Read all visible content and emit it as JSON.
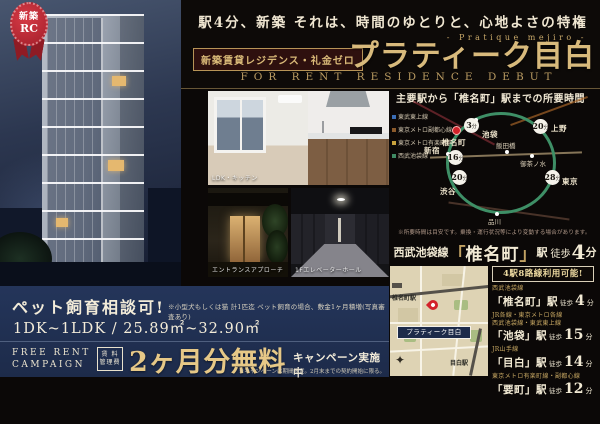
{
  "ribbon": {
    "line1": "新築",
    "line2": "RC"
  },
  "header": {
    "catch": "駅4分、新築 それは、時間のゆとりと、心地よさの特権",
    "sub_en": "- Pratique mejiro -",
    "badge": "新築賃貸レジデンス・礼金ゼロ",
    "title": "プラティーク目白",
    "subtitle_en": "FOR RENT RESIDENCE DEBUT"
  },
  "photos": {
    "caption_main": "LDK・キッチン",
    "caption_entrance": "エントランスアプローチ",
    "caption_hall": "1Fエレベーターホール"
  },
  "route_map": {
    "title": "主要駅から「椎名町」駅までの所要時間",
    "origin": "椎名町",
    "unit": "分",
    "destinations": [
      {
        "name": "池袋",
        "min": "3"
      },
      {
        "name": "新宿",
        "min": "16"
      },
      {
        "name": "渋谷",
        "min": "20"
      },
      {
        "name": "上野",
        "min": "20"
      },
      {
        "name": "東京",
        "min": "28"
      }
    ],
    "via": [
      "飯田橋",
      "御茶ノ水",
      "品川"
    ],
    "lines": [
      "東武東上線",
      "東京メトロ副都心線",
      "東京メトロ有楽町線",
      "西武池袋線"
    ],
    "note": "※所要時間は目安です。乗換・運行状況等により変動する場合があります。"
  },
  "access_banner": {
    "line": "西武池袋線",
    "bracket_open": "「",
    "station": "椎名町",
    "bracket_close": "」",
    "eki": "駅",
    "walk": "徒歩",
    "minutes": "4",
    "unit": "分"
  },
  "map": {
    "station_left": "椎名町駅",
    "station_right": "目白駅",
    "pin_label": "プラティーク目白",
    "compass": "✦"
  },
  "station_list": {
    "header": "4駅8路線利用可能!",
    "items": [
      {
        "lines1": "西武池袋線",
        "lines2": "",
        "station": "「椎名町」駅",
        "mode": "徒歩",
        "minutes": "4",
        "unit": "分"
      },
      {
        "lines1": "JR各線・東京メトロ各線",
        "lines2": "西武池袋線・東武東上線",
        "station": "「池袋」駅",
        "mode": "徒歩",
        "minutes": "15",
        "unit": "分"
      },
      {
        "lines1": "JR山手線",
        "lines2": "",
        "station": "「目白」駅",
        "mode": "徒歩",
        "minutes": "14",
        "unit": "分"
      },
      {
        "lines1": "東京メトロ有楽町線・副都心線",
        "lines2": "",
        "station": "「要町」駅",
        "mode": "徒歩",
        "minutes": "12",
        "unit": "分"
      }
    ]
  },
  "pet_panel": {
    "heading": "ペット飼育相談可!",
    "note": "※小型犬もしくは猫 計1匹迄 ペット飼育の場合、敷金1ヶ月積増(写真審査あり)",
    "plan": "1DK~1LDK / 25.89㎡~32.90㎡",
    "campaign_en1": "FREE RENT",
    "campaign_en2": "CAMPAIGN",
    "fee_label1": "賃 料",
    "fee_label2": "管理費",
    "big": "2ヶ月分無料",
    "tail": "キャンペーン実施中",
    "note2": "※キャンペーンは期間限定。2月末までの契約開始に限る。"
  },
  "colors": {
    "gold": "#d8ba7c",
    "navy": "#1d2b4a",
    "red": "#c0272d",
    "cream": "#f2ead4",
    "green_line": "#3e8f66"
  }
}
